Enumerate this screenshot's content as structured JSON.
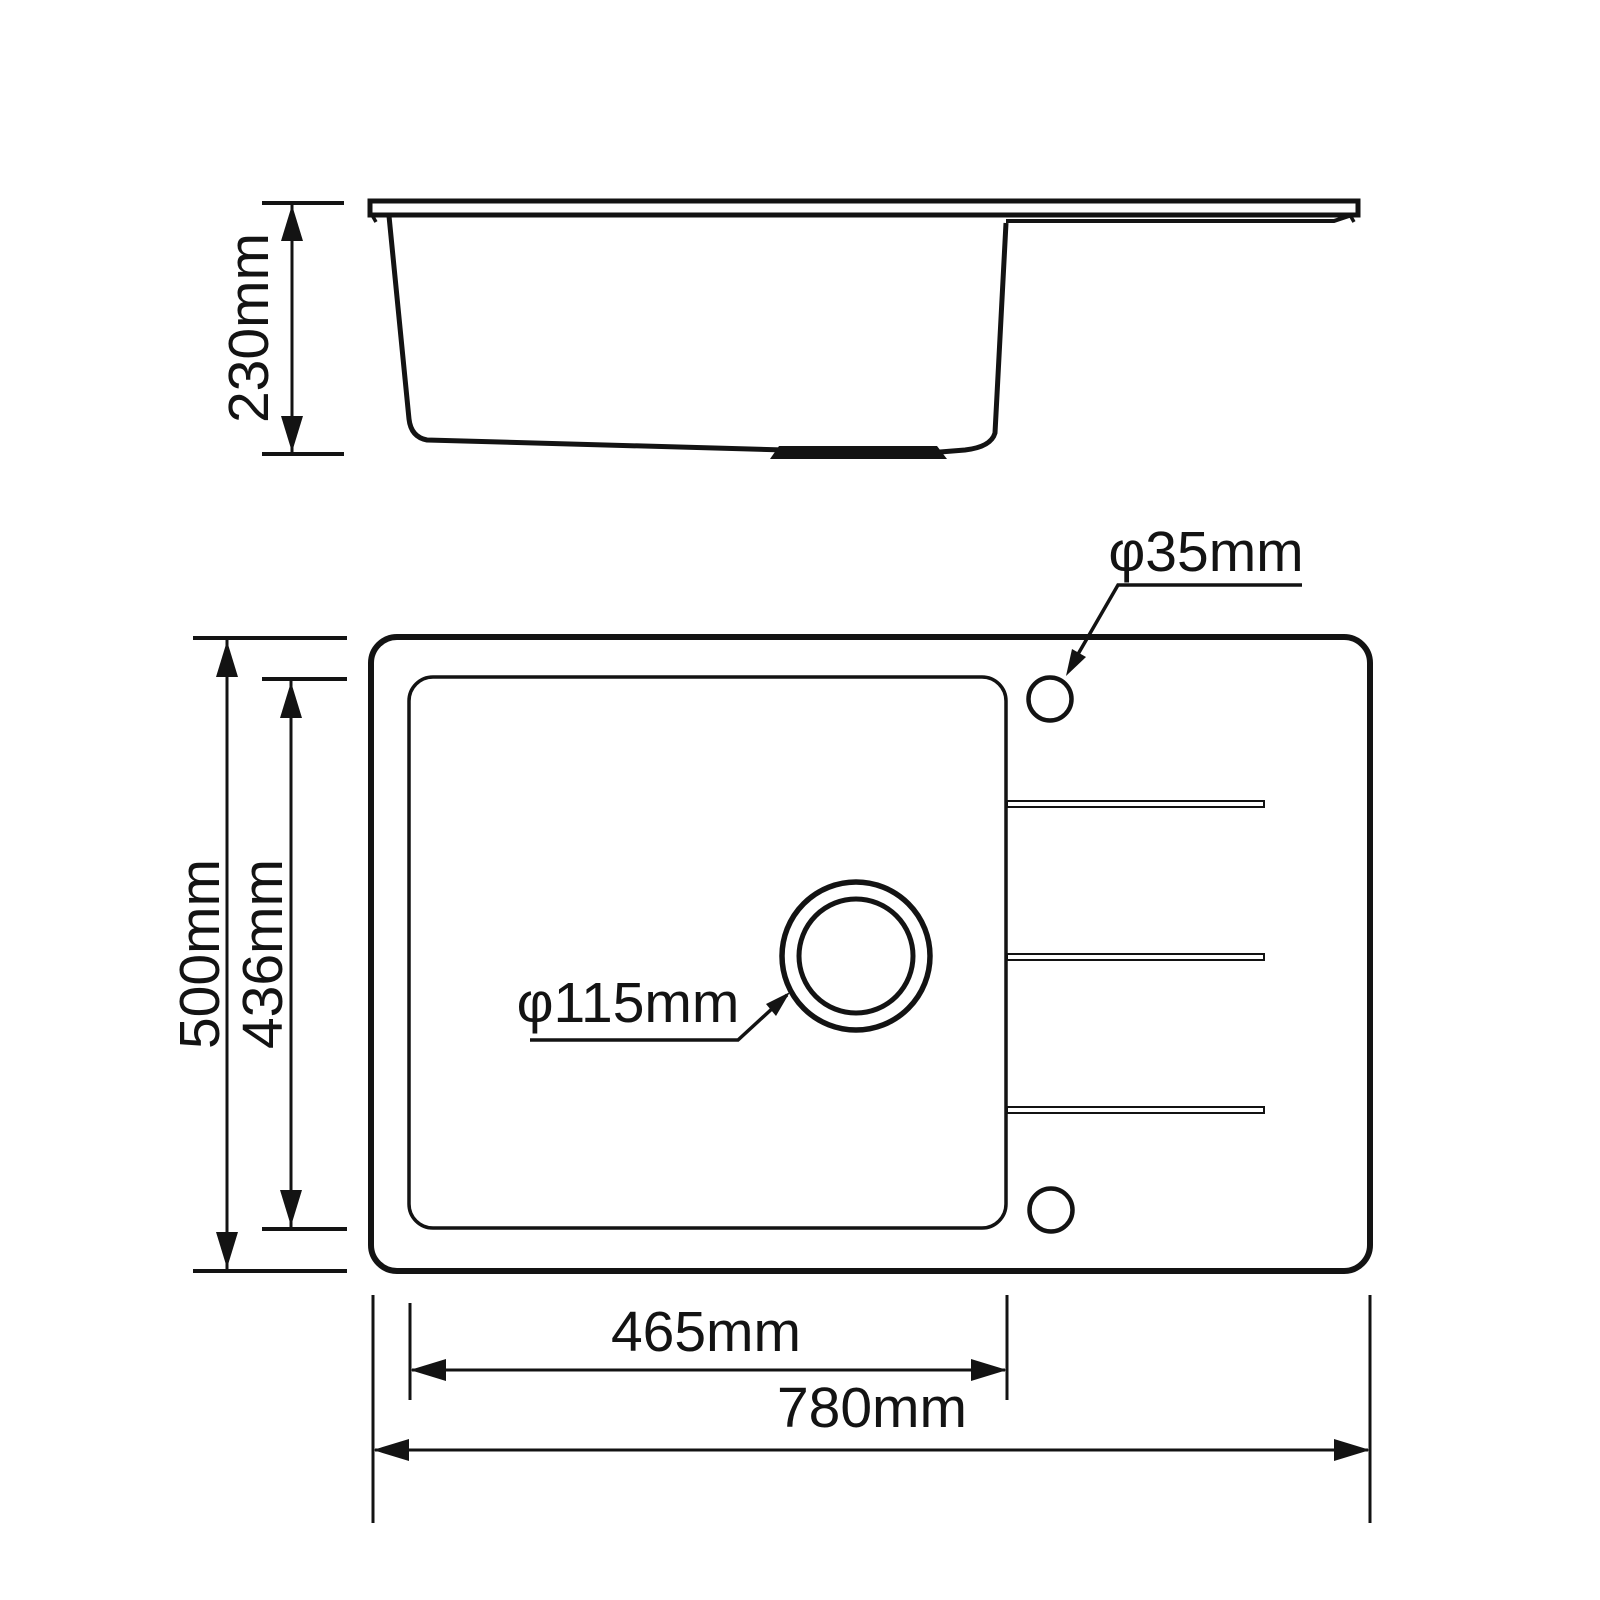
{
  "drawing": {
    "kind": "sink-technical-drawing",
    "labels": {
      "depth": "230mm",
      "overall_width": "500mm",
      "bowl_width": "436mm",
      "bowl_length": "465mm",
      "overall_length": "780mm",
      "faucet_hole_diameter": "φ35mm",
      "drain_diameter": "φ115mm"
    },
    "colors": {
      "line": "#131313",
      "background": "#ffffff"
    }
  }
}
